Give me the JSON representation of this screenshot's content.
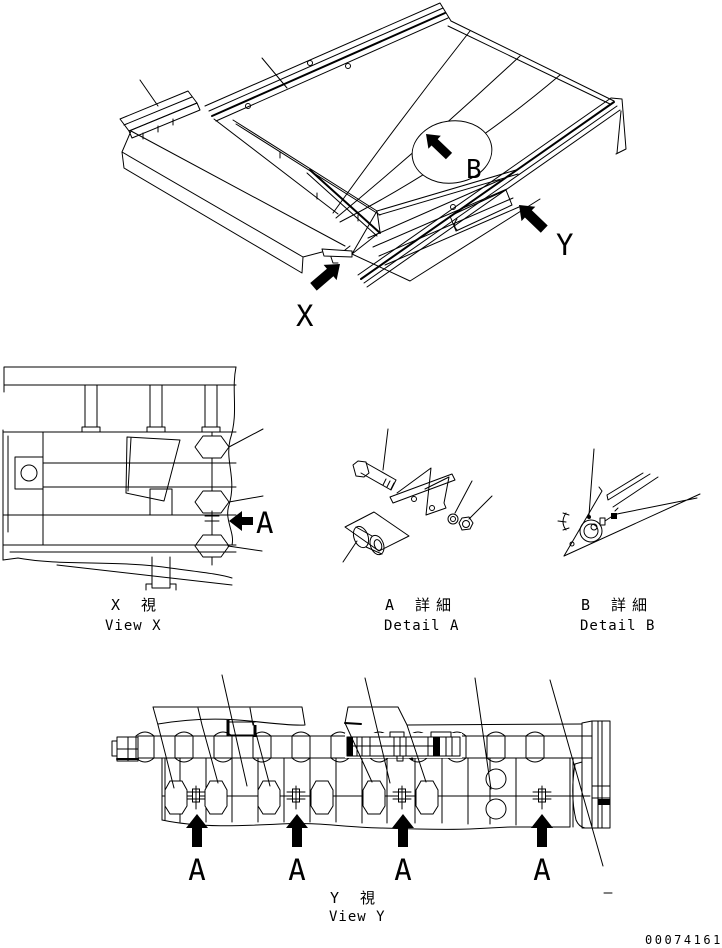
{
  "drawing": {
    "markers": {
      "x": "X",
      "y": "Y",
      "a": "A",
      "b": "B",
      "a_arrows": [
        "A",
        "A",
        "A",
        "A"
      ]
    },
    "captions": {
      "view_x": {
        "cjk": "X 視",
        "en": "View X"
      },
      "detail_a": {
        "cjk": "A 詳細",
        "en": "Detail A"
      },
      "detail_b": {
        "cjk": "B 詳細",
        "en": "Detail B"
      },
      "view_y": {
        "cjk": "Y 視",
        "en": "View Y"
      }
    },
    "doc_number": "00074161",
    "colors": {
      "line": "#000000",
      "background": "#ffffff"
    }
  }
}
